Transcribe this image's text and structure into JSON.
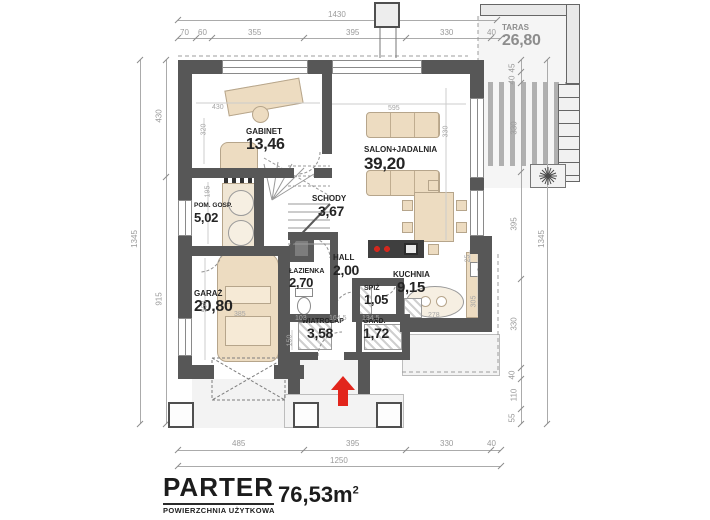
{
  "title": {
    "name": "PARTER",
    "subtitle": "POWIERZCHNIA UŻYTKOWA",
    "area": "76,53m",
    "area_sup": "2"
  },
  "rooms": {
    "gabinet": {
      "name": "GABINET",
      "area": "13,46"
    },
    "salon": {
      "name": "SALON+JADALNIA",
      "area": "39,20"
    },
    "schody": {
      "name": "SCHODY",
      "area": "3,67"
    },
    "hall": {
      "name": "HALL",
      "area": "2,00"
    },
    "lazienka": {
      "name": "ŁAZIENKA",
      "area": "2,70"
    },
    "pomgosp": {
      "name": "POM. GOSP.",
      "area": "5,02"
    },
    "garaz": {
      "name": "GARAŻ",
      "area": "20,80"
    },
    "kuchnia": {
      "name": "KUCHNIA",
      "area": "9,15"
    },
    "spiz": {
      "name": "SPIŻ",
      "area": "1,05"
    },
    "wiatrolap": {
      "name": "WIATROŁAP",
      "area": "3,58"
    },
    "gard": {
      "name": "GARD.",
      "area": "1,72"
    },
    "taras": {
      "name": "TARAS",
      "area": "26,80"
    }
  },
  "dims": {
    "top_total": "1430",
    "top_segments": [
      "70",
      "60",
      "355",
      "395",
      "330",
      "40"
    ],
    "bottom_segments": [
      "485",
      "395",
      "330",
      "40"
    ],
    "bottom_total": "1250",
    "left_total": "1345",
    "left_segments": [
      "430",
      "915"
    ],
    "right_total": "1345",
    "right_segments": [
      "45",
      "40",
      "330",
      "395",
      "330",
      "40",
      "110",
      "55"
    ],
    "interior": {
      "gabinet_w": "430",
      "gabinet_h": "320",
      "pomgosp_h": "195",
      "salon_w": "595",
      "salon_h": "330",
      "garaz_h": "550",
      "garaz_w": "385",
      "lazienka_w": "103",
      "wiatrolap_w": "164,5",
      "gard_w": "134,5",
      "kuchnia_w": "278",
      "kuchnia_h": "305",
      "kuchnia_gap": "25",
      "porch_h": "150"
    }
  },
  "colors": {
    "wall": "#575757",
    "furniture": "#eddcc1",
    "accent_red": "#e2251c",
    "dimension_gray": "#9b9b9b",
    "label_dark": "#242424"
  }
}
